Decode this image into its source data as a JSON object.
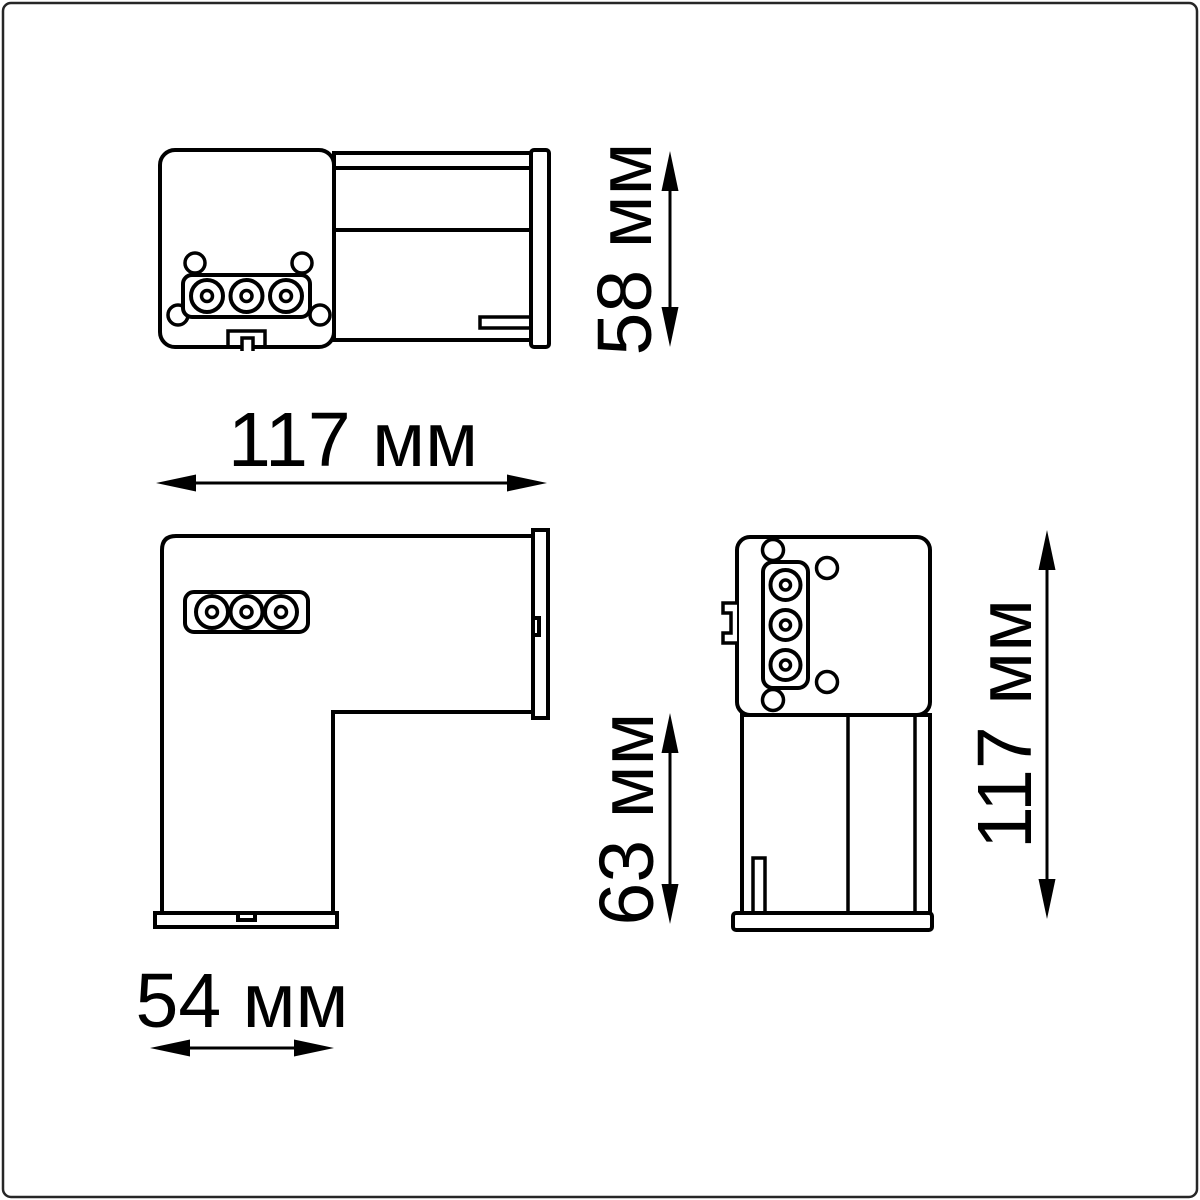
{
  "drawing": {
    "kind": "technical dimension drawing, 3 orthographic views of an L-shaped track connector",
    "unit": "мм",
    "background_color": "#ffffff",
    "line_color": "#000000",
    "frame_color": "#262626"
  },
  "dimensions": [
    {
      "id": "top-width",
      "label": "117 мм",
      "value": 117,
      "unit": "мм",
      "orientation": "horizontal"
    },
    {
      "id": "side-height",
      "label": "58 мм",
      "value": 58,
      "unit": "мм",
      "orientation": "vertical"
    },
    {
      "id": "leg-height",
      "label": "63 мм",
      "value": 63,
      "unit": "мм",
      "orientation": "vertical"
    },
    {
      "id": "front-height",
      "label": "117 мм",
      "value": 117,
      "unit": "мм",
      "orientation": "vertical"
    },
    {
      "id": "leg-width",
      "label": "54 мм",
      "value": 54,
      "unit": "мм",
      "orientation": "horizontal"
    }
  ]
}
